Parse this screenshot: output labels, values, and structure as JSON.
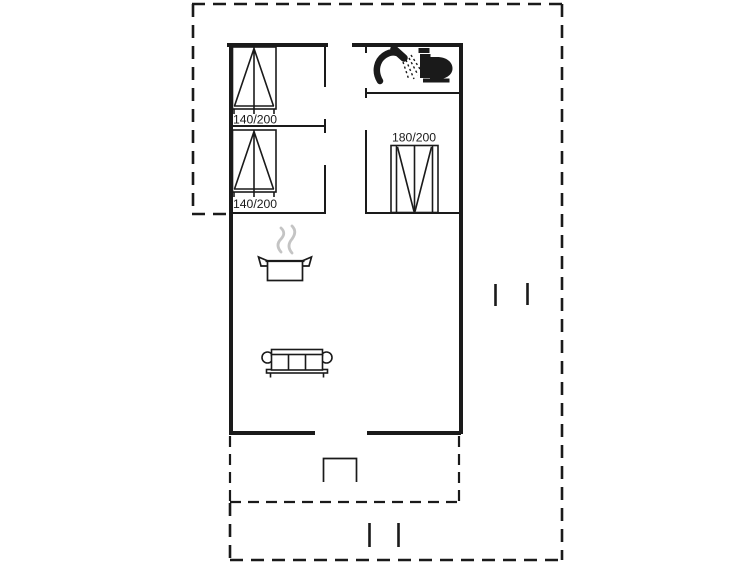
{
  "window": {
    "title": "Holiday house floor plan",
    "background": "#ffffff"
  },
  "colors": {
    "line": "#1a1a1a",
    "steam": "#c4c4c4"
  },
  "floorplan": {
    "beds": [
      {
        "name": "bed-140x200-upper",
        "label": "140/200"
      },
      {
        "name": "bed-140x200-lower",
        "label": "140/200"
      },
      {
        "name": "bed-180x200",
        "label": "180/200"
      }
    ],
    "fixtures": [
      {
        "icon": "shower-icon"
      },
      {
        "icon": "toilet-icon"
      },
      {
        "icon": "cooking-pot-icon"
      },
      {
        "icon": "steam-icon"
      },
      {
        "icon": "sofa-icon"
      },
      {
        "icon": "entrance-step-icon"
      },
      {
        "icon": "opening-marker-icon"
      }
    ]
  }
}
